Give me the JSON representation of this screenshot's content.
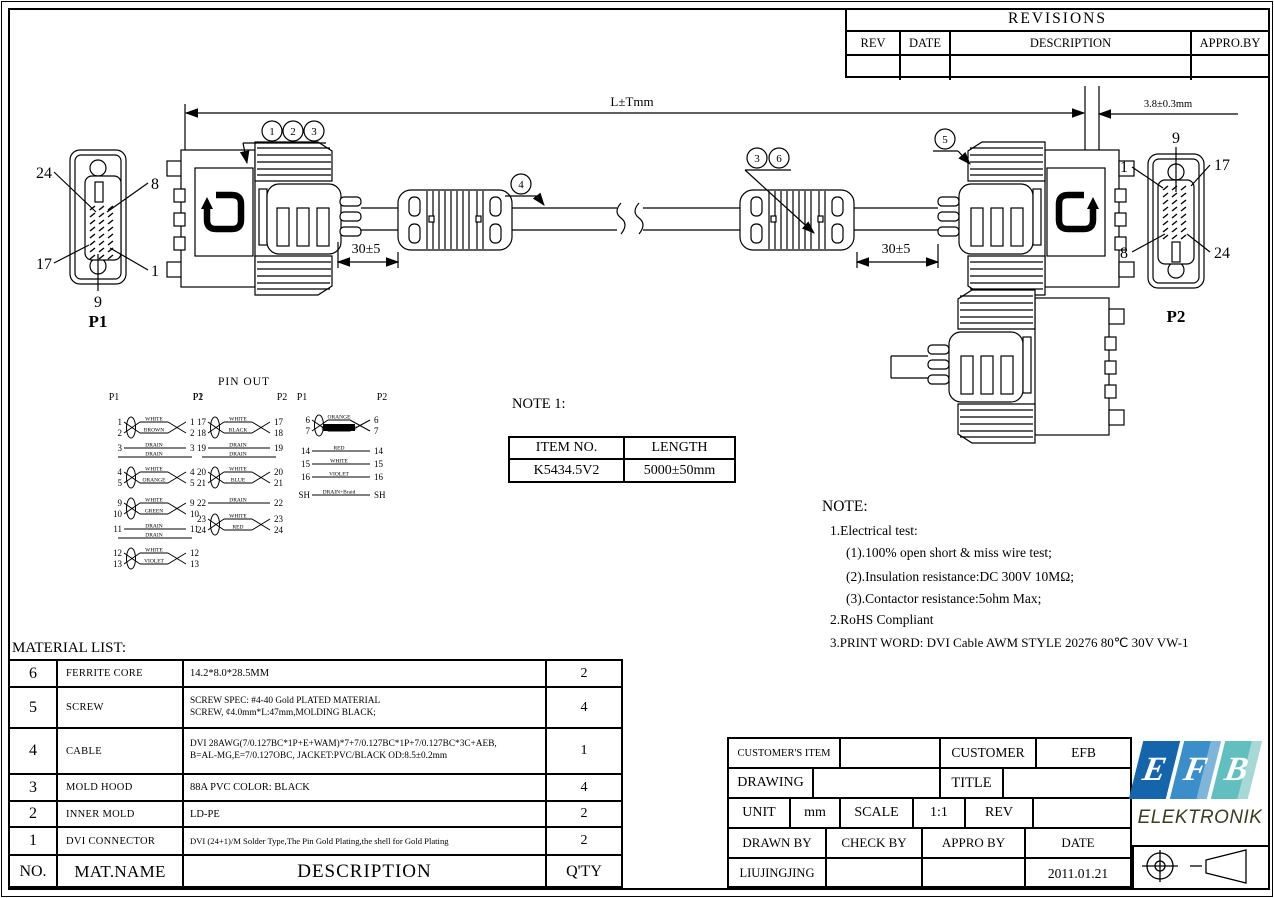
{
  "revisions": {
    "title": "REVISIONS",
    "col_rev": "REV",
    "col_date": "DATE",
    "col_description": "DESCRIPTION",
    "col_approby": "APPRO.BY"
  },
  "dims": {
    "overall": "L±Tmm",
    "nose": "3.8±0.3mm",
    "left_ferrite": "30±5",
    "right_ferrite": "30±5"
  },
  "p1": {
    "name": "P1",
    "pin_tl": "24",
    "pin_tr": "8",
    "pin_bl": "17",
    "pin_br": "1",
    "pin_b": "9"
  },
  "p2": {
    "name": "P2",
    "pin_t": "9",
    "pin_tl": "1",
    "pin_tr": "17",
    "pin_bl": "8",
    "pin_br": "24"
  },
  "callouts": {
    "a": "1",
    "b": "2",
    "c": "3",
    "d": "4",
    "e": "3",
    "f": "6",
    "g": "5"
  },
  "pinout": {
    "title": "PIN OUT",
    "columns": [
      {
        "p1": "P1",
        "p2": "P2",
        "groups": [
          {
            "type": "pair",
            "pins": [
              "1",
              "2"
            ],
            "colors": [
              "WHITE",
              "BROWN"
            ]
          },
          {
            "type": "single",
            "pin": "3",
            "color": "DRAIN"
          },
          {
            "type": "bare",
            "color": "DRAIN"
          },
          {
            "type": "pair",
            "pins": [
              "4",
              "5"
            ],
            "colors": [
              "WHITE",
              "ORANGE"
            ]
          },
          {
            "type": "gap"
          },
          {
            "type": "pair",
            "pins": [
              "9",
              "10"
            ],
            "colors": [
              "WHITE",
              "GREEN"
            ]
          },
          {
            "type": "single",
            "pin": "11",
            "color": "DRAIN"
          },
          {
            "type": "bare",
            "color": "DRAIN"
          },
          {
            "type": "pair",
            "pins": [
              "12",
              "13"
            ],
            "colors": [
              "WHITE",
              "VIOLET"
            ]
          }
        ]
      },
      {
        "p1": "P1",
        "p2": "P2",
        "groups": [
          {
            "type": "pair",
            "pins": [
              "17",
              "18"
            ],
            "colors": [
              "WHITE",
              "BLACK"
            ]
          },
          {
            "type": "single",
            "pin": "19",
            "color": "DRAIN"
          },
          {
            "type": "bare",
            "color": "DRAIN"
          },
          {
            "type": "pair",
            "pins": [
              "20",
              "21"
            ],
            "colors": [
              "WHITE",
              "BLUE"
            ]
          },
          {
            "type": "gap"
          },
          {
            "type": "single",
            "pin": "22",
            "color": "DRAIN"
          },
          {
            "type": "gap2"
          },
          {
            "type": "pair",
            "pins": [
              "23",
              "24"
            ],
            "colors": [
              "WHITE",
              "RED"
            ]
          }
        ]
      },
      {
        "p1": "P1",
        "p2": "P2",
        "groups": [
          {
            "type": "pair",
            "pins": [
              "6",
              "7"
            ],
            "colors": [
              "ORANGE",
              "RED/ORANGE"
            ],
            "inverted": 1
          },
          {
            "type": "gap"
          },
          {
            "type": "single",
            "pin": "14",
            "color": "RED"
          },
          {
            "type": "single",
            "pin": "15",
            "color": "WHITE"
          },
          {
            "type": "single",
            "pin": "16",
            "color": "VIOLET"
          },
          {
            "type": "gap"
          },
          {
            "type": "single",
            "pin": "SH",
            "color": "DRAIN+Braid"
          }
        ]
      }
    ]
  },
  "note1": {
    "title": "NOTE 1:",
    "item_no_label": "ITEM NO.",
    "length_label": "LENGTH",
    "item_no": "K5434.5V2",
    "length": "5000±50mm"
  },
  "note": {
    "title": "NOTE:",
    "l1": "1.Electrical test:",
    "l2": "(1).100% open short & miss wire test;",
    "l3": "(2).Insulation resistance:DC 300V 10MΩ;",
    "l4": "(3).Contactor resistance:5ohm Max;",
    "l5": "2.RoHS Compliant",
    "l6": "3.PRINT WORD: DVI Cable AWM STYLE 20276 80℃ 30V VW-1"
  },
  "material_list": {
    "title": "MATERIAL LIST:",
    "h_no": "NO.",
    "h_name": "MAT.NAME",
    "h_desc": "DESCRIPTION",
    "h_qty": "Q'TY",
    "rows": [
      {
        "no": "6",
        "name": "FERRITE CORE",
        "d1": "14.2*8.0*28.5MM",
        "d2": "",
        "qty": "2"
      },
      {
        "no": "5",
        "name": "SCREW",
        "d1": "SCREW SPEC: #4-40 Gold PLATED MATERIAL",
        "d2": "SCREW, ¢4.0mm*L:47mm,MOLDING BLACK;",
        "qty": "4"
      },
      {
        "no": "4",
        "name": "CABLE",
        "d1": "DVI 28AWG(7/0.127BC*1P+E+WAM)*7+7/0.127BC*1P+7/0.127BC*3C+AEB,",
        "d2": "B=AL-MG,E=7/0.127OBC, JACKET:PVC/BLACK OD:8.5±0.2mm",
        "qty": "1"
      },
      {
        "no": "3",
        "name": "MOLD HOOD",
        "d1": "88A PVC COLOR: BLACK",
        "d2": "",
        "qty": "4"
      },
      {
        "no": "2",
        "name": "INNER MOLD",
        "d1": "LD-PE",
        "d2": "",
        "qty": "2"
      },
      {
        "no": "1",
        "name": "DVI CONNECTOR",
        "d1": "DVI (24+1)/M Solder Type,The Pin Gold Plating,the shell for Gold Plating",
        "d2": "",
        "qty": "2"
      }
    ]
  },
  "title_block": {
    "customers_item": "CUSTOMER'S ITEM",
    "customer": "CUSTOMER",
    "customer_value": "EFB",
    "drawing": "DRAWING",
    "title": "TITLE",
    "unit": "UNIT",
    "unit_value": "mm",
    "scale": "SCALE",
    "scale_value": "1:1",
    "rev": "REV",
    "drawn_by": "DRAWN BY",
    "check_by": "CHECK BY",
    "appro_by": "APPRO BY",
    "date": "DATE",
    "drawn_by_value": "LIUJINGJING",
    "date_value": "2011.01.21"
  },
  "logo": {
    "l1": "E",
    "l2": "F",
    "l3": "B",
    "subtitle": "ELEKTRONIK",
    "colors": {
      "e": "#1565ad",
      "f": "#3a8ec9",
      "f2": "#7fb5d9",
      "b": "#62bfc0",
      "b2": "#a8d8d6",
      "text": "#3a3e20"
    }
  }
}
